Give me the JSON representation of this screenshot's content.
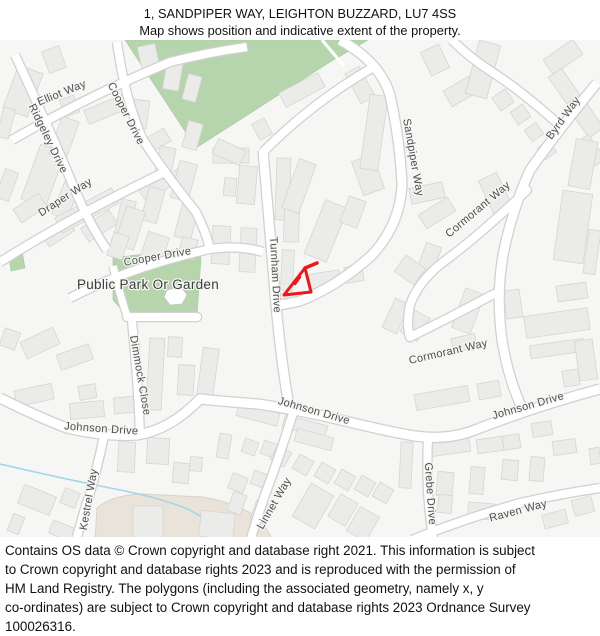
{
  "title": {
    "line1": "1, SANDPIPER WAY, LEIGHTON BUZZARD, LU7 4SS",
    "line2": "Map shows position and indicative extent of the property."
  },
  "footer": {
    "lines": [
      "Contains OS data © Crown copyright and database right 2021. This information is subject",
      "to Crown copyright and database rights 2023 and is reproduced with the permission of",
      "HM Land Registry. The polygons (including the associated geometry, namely x, y",
      "co-ordinates) are subject to Crown copyright and database rights 2023 Ordnance Survey",
      "100026316."
    ]
  },
  "map": {
    "background": "#f6f6f4",
    "road_fill": "#ffffff",
    "road_casing": "#d2d1cf",
    "building_fill": "#ebebe9",
    "building_stroke": "#d6d5d3",
    "green_fill": "#b6d5ac",
    "green_stroke": "#a8c99e",
    "beige_fill": "#e9e3da",
    "beige_stroke": "#d9d2c6",
    "stream_color": "#a5d5e8",
    "label_color": "#4d4d4d",
    "park_label_color": "#3c3c3c",
    "property_color": "#e8191f",
    "greens": [
      "125,40 368,40 330,62 196,148",
      "113,258 198,247 201,258 197,317 131,320 113,300",
      "8,252 22,250 25,268 11,271"
    ],
    "green_path": "M322,40 L344,66",
    "pond": "167,290 181,287 187,295 182,304 170,305 164,297",
    "beige": "M95,540 L97,508 Q112,495 142,494 L202,497 Q238,503 260,519 L273,540 Z",
    "stream": "M0,464 Q60,478 120,490 Q160,498 185,508 Q215,521 222,540",
    "roads": [
      {
        "name": "ridgeley-drive",
        "d": "M15,55 Q50,130 75,190 Q90,225 107,250",
        "w": 8
      },
      {
        "name": "elliot-way",
        "d": "M12,140 Q90,95 170,62 Q210,52 247,47",
        "w": 8
      },
      {
        "name": "cooper-drive-north",
        "d": "M117,42 Q125,100 143,140 Q168,178 196,212 Q206,232 210,249",
        "w": 8
      },
      {
        "name": "draper-way",
        "d": "M0,262 Q80,212 165,172",
        "w": 8
      },
      {
        "name": "cooper-drive-south",
        "d": "M70,298 Q130,267 210,249 Q240,245 263,252",
        "w": 8
      },
      {
        "name": "dimmock-close-top",
        "d": "M113,266 Q120,295 127,316",
        "w": 7
      },
      {
        "name": "dimmock-close-culdesac",
        "d": "M127,317 L197,317",
        "w": 8,
        "cap": "round"
      },
      {
        "name": "dimmock-close",
        "d": "M132,321 Q138,380 140,434",
        "w": 8
      },
      {
        "name": "turnham-link",
        "d": "M263,152 Q300,115 340,88 Q358,76 372,68",
        "w": 8
      },
      {
        "name": "turnham-drive",
        "d": "M263,150 Q270,230 276,305 Q282,370 290,410",
        "w": 9
      },
      {
        "name": "sandpiper-way",
        "d": "M340,40 Q380,62 390,95 Q400,140 402,185 Q400,225 372,255 Q338,286 300,301 L276,306",
        "w": 9
      },
      {
        "name": "top-right-road",
        "d": "M452,40 Q470,58 492,72 Q520,90 556,122",
        "w": 8
      },
      {
        "name": "byrd-way",
        "d": "M597,83 Q560,128 530,170 Q512,210 503,255 Q496,295 502,340 Q508,378 522,408",
        "w": 9
      },
      {
        "name": "cormorant-way-upper",
        "d": "M527,190 Q480,235 442,263 Q418,282 410,305 Q406,325 410,337",
        "w": 8,
        "cap": "round"
      },
      {
        "name": "cormorant-way-lower",
        "d": "M410,337 Q445,320 494,294",
        "w": 8,
        "cap": "round"
      },
      {
        "name": "johnson-drive",
        "d": "M0,398 Q40,418 67,428 Q105,437 137,435 Q170,430 200,399 Q230,402 258,404 Q300,410 345,421 Q390,432 415,436 Q450,441 480,428 Q540,405 600,389",
        "w": 9
      },
      {
        "name": "kestrel-way",
        "d": "M104,436 Q96,475 84,512 L76,540",
        "w": 8
      },
      {
        "name": "linnet-way",
        "d": "M293,413 Q280,455 265,495 Q258,515 251,538",
        "w": 8
      },
      {
        "name": "grebe-drive",
        "d": "M428,438 Q426,480 430,515 L433,540",
        "w": 8
      },
      {
        "name": "raven-way",
        "d": "M412,540 Q460,520 520,503 Q560,494 600,488",
        "w": 8
      }
    ],
    "buildings": [
      [
        10,
        68,
        26,
        46,
        20
      ],
      [
        45,
        48,
        18,
        23,
        -20
      ],
      [
        62,
        97,
        15,
        18,
        -20
      ],
      [
        0,
        108,
        12,
        30,
        15
      ],
      [
        30,
        147,
        26,
        58,
        20
      ],
      [
        55,
        118,
        18,
        40,
        20
      ],
      [
        85,
        102,
        42,
        15,
        -22
      ],
      [
        140,
        45,
        18,
        28,
        -12
      ],
      [
        165,
        60,
        16,
        30,
        10
      ],
      [
        185,
        75,
        14,
        26,
        15
      ],
      [
        132,
        100,
        16,
        28,
        8
      ],
      [
        145,
        133,
        24,
        15,
        -30
      ],
      [
        185,
        122,
        15,
        27,
        15
      ],
      [
        140,
        180,
        28,
        16,
        -35
      ],
      [
        170,
        168,
        22,
        14,
        -35
      ],
      [
        0,
        170,
        14,
        30,
        20
      ],
      [
        15,
        200,
        30,
        16,
        -33
      ],
      [
        43,
        225,
        30,
        15,
        -33
      ],
      [
        82,
        218,
        34,
        16,
        -33
      ],
      [
        58,
        182,
        16,
        36,
        22
      ],
      [
        118,
        200,
        15,
        34,
        12
      ],
      [
        55,
        202,
        64,
        17,
        -28
      ],
      [
        157,
        147,
        16,
        32,
        12
      ],
      [
        175,
        162,
        18,
        38,
        15
      ],
      [
        145,
        188,
        16,
        34,
        15
      ],
      [
        120,
        208,
        20,
        40,
        18
      ],
      [
        178,
        205,
        17,
        34,
        15
      ],
      [
        110,
        234,
        16,
        24,
        18
      ],
      [
        144,
        234,
        22,
        26,
        18
      ],
      [
        180,
        238,
        16,
        20,
        15
      ],
      [
        213,
        148,
        36,
        15,
        0
      ],
      [
        238,
        166,
        18,
        38,
        5
      ],
      [
        224,
        178,
        12,
        18,
        5
      ],
      [
        212,
        226,
        18,
        38,
        3
      ],
      [
        240,
        228,
        16,
        44,
        3
      ],
      [
        276,
        158,
        14,
        62,
        2
      ],
      [
        284,
        208,
        15,
        34,
        2
      ],
      [
        281,
        250,
        12,
        56,
        3
      ],
      [
        310,
        272,
        30,
        15,
        -8
      ],
      [
        345,
        266,
        18,
        16,
        -10
      ],
      [
        280,
        82,
        44,
        16,
        -28
      ],
      [
        352,
        68,
        16,
        34,
        -28
      ],
      [
        255,
        120,
        14,
        18,
        -28
      ],
      [
        214,
        144,
        30,
        16,
        25
      ],
      [
        290,
        160,
        18,
        52,
        20
      ],
      [
        314,
        202,
        24,
        58,
        22
      ],
      [
        344,
        198,
        18,
        28,
        20
      ],
      [
        357,
        157,
        22,
        36,
        -20
      ],
      [
        365,
        95,
        18,
        75,
        8
      ],
      [
        425,
        47,
        20,
        26,
        -25
      ],
      [
        445,
        80,
        40,
        18,
        -30
      ],
      [
        472,
        42,
        22,
        55,
        15
      ],
      [
        545,
        48,
        36,
        18,
        -35
      ],
      [
        495,
        92,
        16,
        16,
        -35
      ],
      [
        513,
        107,
        15,
        15,
        -35
      ],
      [
        527,
        125,
        14,
        14,
        -35
      ],
      [
        540,
        143,
        14,
        14,
        -35
      ],
      [
        556,
        70,
        16,
        32,
        -35
      ],
      [
        577,
        100,
        18,
        36,
        -35
      ],
      [
        586,
        135,
        12,
        30,
        -35
      ],
      [
        572,
        140,
        22,
        48,
        10
      ],
      [
        558,
        192,
        30,
        70,
        8
      ],
      [
        586,
        230,
        12,
        44,
        8
      ],
      [
        410,
        185,
        34,
        16,
        -12
      ],
      [
        420,
        205,
        34,
        16,
        -32
      ],
      [
        420,
        244,
        16,
        36,
        20
      ],
      [
        398,
        260,
        24,
        20,
        35
      ],
      [
        485,
        175,
        20,
        36,
        -25
      ],
      [
        388,
        300,
        16,
        32,
        25
      ],
      [
        405,
        312,
        20,
        26,
        30
      ],
      [
        458,
        290,
        20,
        42,
        20
      ],
      [
        505,
        290,
        16,
        28,
        -8
      ],
      [
        557,
        284,
        30,
        16,
        -8
      ],
      [
        525,
        312,
        64,
        22,
        -8
      ],
      [
        530,
        342,
        54,
        13,
        -8
      ],
      [
        577,
        340,
        18,
        40,
        -8
      ],
      [
        563,
        370,
        16,
        16,
        -8
      ],
      [
        452,
        336,
        24,
        14,
        -12
      ],
      [
        415,
        390,
        54,
        16,
        -10
      ],
      [
        478,
        382,
        22,
        16,
        -10
      ],
      [
        2,
        330,
        16,
        18,
        20
      ],
      [
        22,
        334,
        36,
        18,
        -25
      ],
      [
        58,
        349,
        34,
        16,
        -20
      ],
      [
        15,
        387,
        38,
        16,
        -12
      ],
      [
        79,
        385,
        17,
        14,
        -10
      ],
      [
        70,
        402,
        34,
        16,
        -5
      ],
      [
        114,
        397,
        24,
        16,
        -5
      ],
      [
        148,
        338,
        15,
        72,
        3
      ],
      [
        168,
        337,
        14,
        20,
        3
      ],
      [
        178,
        365,
        16,
        30,
        3
      ],
      [
        200,
        348,
        16,
        48,
        8
      ],
      [
        20,
        490,
        34,
        20,
        22
      ],
      [
        50,
        525,
        30,
        14,
        22
      ],
      [
        62,
        490,
        16,
        16,
        22
      ],
      [
        10,
        515,
        12,
        18,
        22
      ],
      [
        118,
        442,
        17,
        30,
        3
      ],
      [
        147,
        438,
        22,
        26,
        3
      ],
      [
        173,
        463,
        16,
        20,
        5
      ],
      [
        190,
        457,
        12,
        14,
        5
      ],
      [
        218,
        434,
        12,
        24,
        10
      ],
      [
        243,
        440,
        14,
        14,
        20
      ],
      [
        262,
        442,
        14,
        14,
        20
      ],
      [
        273,
        448,
        16,
        16,
        30
      ],
      [
        295,
        457,
        16,
        16,
        30
      ],
      [
        317,
        465,
        16,
        16,
        30
      ],
      [
        337,
        472,
        16,
        16,
        30
      ],
      [
        357,
        478,
        16,
        16,
        30
      ],
      [
        375,
        485,
        16,
        16,
        30
      ],
      [
        230,
        475,
        16,
        16,
        20
      ],
      [
        252,
        472,
        14,
        14,
        20
      ],
      [
        230,
        493,
        14,
        20,
        20
      ],
      [
        253,
        502,
        16,
        20,
        20
      ],
      [
        300,
        487,
        26,
        38,
        30
      ],
      [
        333,
        497,
        20,
        26,
        30
      ],
      [
        352,
        510,
        22,
        28,
        30
      ],
      [
        237,
        408,
        42,
        13,
        15
      ],
      [
        283,
        420,
        44,
        13,
        15
      ],
      [
        295,
        433,
        38,
        13,
        15
      ],
      [
        400,
        442,
        12,
        46,
        3
      ],
      [
        430,
        440,
        40,
        14,
        -8
      ],
      [
        477,
        438,
        26,
        14,
        -8
      ],
      [
        503,
        435,
        17,
        14,
        -8
      ],
      [
        532,
        422,
        20,
        14,
        -8
      ],
      [
        553,
        440,
        23,
        14,
        -8
      ],
      [
        470,
        467,
        14,
        27,
        5
      ],
      [
        502,
        460,
        16,
        20,
        5
      ],
      [
        530,
        457,
        14,
        24,
        5
      ],
      [
        437,
        472,
        16,
        24,
        5
      ],
      [
        438,
        495,
        14,
        18,
        5
      ],
      [
        468,
        503,
        26,
        16,
        5
      ],
      [
        543,
        512,
        24,
        14,
        -15
      ],
      [
        573,
        498,
        20,
        16,
        -15
      ],
      [
        590,
        448,
        10,
        16,
        -8
      ],
      [
        133,
        506,
        30,
        34,
        0
      ],
      [
        200,
        512,
        34,
        26,
        6
      ]
    ],
    "labels": [
      {
        "t": "Elliot Way",
        "x": 63,
        "y": 96,
        "r": -22
      },
      {
        "t": "Ridgeley Drive",
        "x": 45,
        "y": 140,
        "r": 64
      },
      {
        "t": "Cooper Drive",
        "x": 123,
        "y": 115,
        "r": 63
      },
      {
        "t": "Draper Way",
        "x": 67,
        "y": 200,
        "r": -33
      },
      {
        "t": "Cooper Drive",
        "x": 158,
        "y": 260,
        "r": -10
      },
      {
        "t": "Public Park Or Garden",
        "x": 148,
        "y": 289,
        "r": 0,
        "s": 13.5,
        "park": true
      },
      {
        "t": "Dimmock Close",
        "x": 137,
        "y": 376,
        "r": 80
      },
      {
        "t": "Turnham Drive",
        "x": 272,
        "y": 275,
        "r": 87
      },
      {
        "t": "Sandpiper Way",
        "x": 410,
        "y": 158,
        "r": 80
      },
      {
        "t": "Byrd Way",
        "x": 566,
        "y": 120,
        "r": -54
      },
      {
        "t": "Cormorant Way",
        "x": 480,
        "y": 212,
        "r": -40
      },
      {
        "t": "Cormorant Way",
        "x": 449,
        "y": 355,
        "r": -13
      },
      {
        "t": "Johnson Drive",
        "x": 101,
        "y": 432,
        "r": 4
      },
      {
        "t": "Johnson Drive",
        "x": 313,
        "y": 414,
        "r": 16
      },
      {
        "t": "Johnson Drive",
        "x": 529,
        "y": 409,
        "r": -16
      },
      {
        "t": "Kestrel Way",
        "x": 92,
        "y": 500,
        "r": -80
      },
      {
        "t": "Linnet Way",
        "x": 277,
        "y": 505,
        "r": -60
      },
      {
        "t": "Grebe Drive",
        "x": 427,
        "y": 494,
        "r": 86
      },
      {
        "t": "Raven Way",
        "x": 519,
        "y": 514,
        "r": -15
      }
    ],
    "property": {
      "outline": "M305,268 L311,292 L284,295 Z",
      "flag": "M305,268 L317,263",
      "tick": "M295,284 L300,277"
    }
  }
}
